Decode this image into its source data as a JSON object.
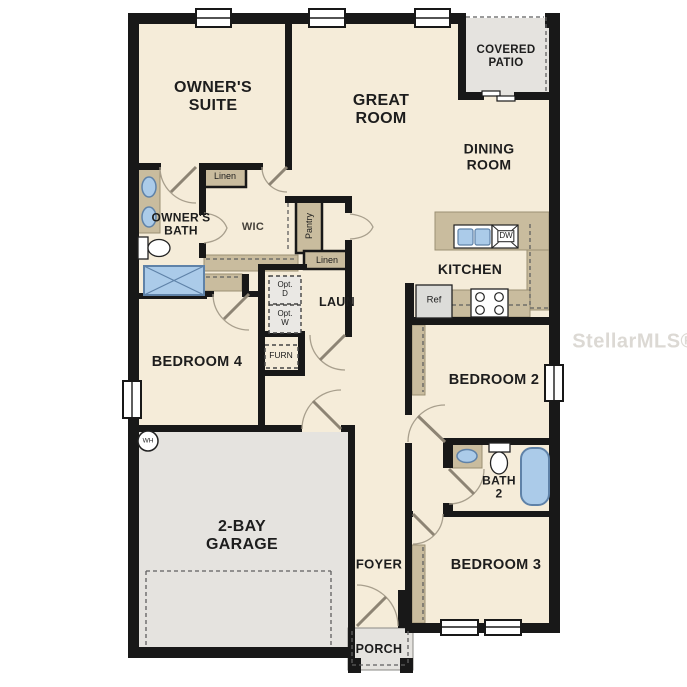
{
  "watermark": "StellarMLS®",
  "colors": {
    "floor": "#f5ecd9",
    "wall": "#181818",
    "tan": "#c9bc9e",
    "tanEdge": "#9b8f74",
    "gray": "#e5e3df",
    "grayBox": "#eae8e4",
    "blue": "#abcbe9",
    "blueEdge": "#5f82a8",
    "doorArc": "#a89f8d",
    "doorLeaf": "#8d8474",
    "dash": "#5f5f5f",
    "label": "#1d1d1d",
    "watermark": "#dcd9d4"
  },
  "rooms": {
    "owners_suite": "OWNER'S\nSUITE",
    "great_room": "GREAT\nROOM",
    "covered_patio": "COVERED\nPATIO",
    "dining_room": "DINING\nROOM",
    "kitchen": "KITCHEN",
    "owners_bath": "OWNER'S\nBATH",
    "wic": "WIC",
    "laundry": "LAUN",
    "bedroom4": "BEDROOM 4",
    "bedroom2": "BEDROOM 2",
    "bath2": "BATH\n2",
    "bedroom3": "BEDROOM 3",
    "garage": "2-BAY\nGARAGE",
    "foyer": "FOYER",
    "porch": "PORCH"
  },
  "closets": {
    "linen1": "Linen",
    "linen2": "Linen",
    "pantry": "Pantry"
  },
  "appliances": {
    "ref": "Ref",
    "dw": "DW",
    "opt_dryer": "Opt.\nD",
    "opt_washer": "Opt.\nW",
    "furnace": "FURN",
    "water_heater": "WH"
  }
}
